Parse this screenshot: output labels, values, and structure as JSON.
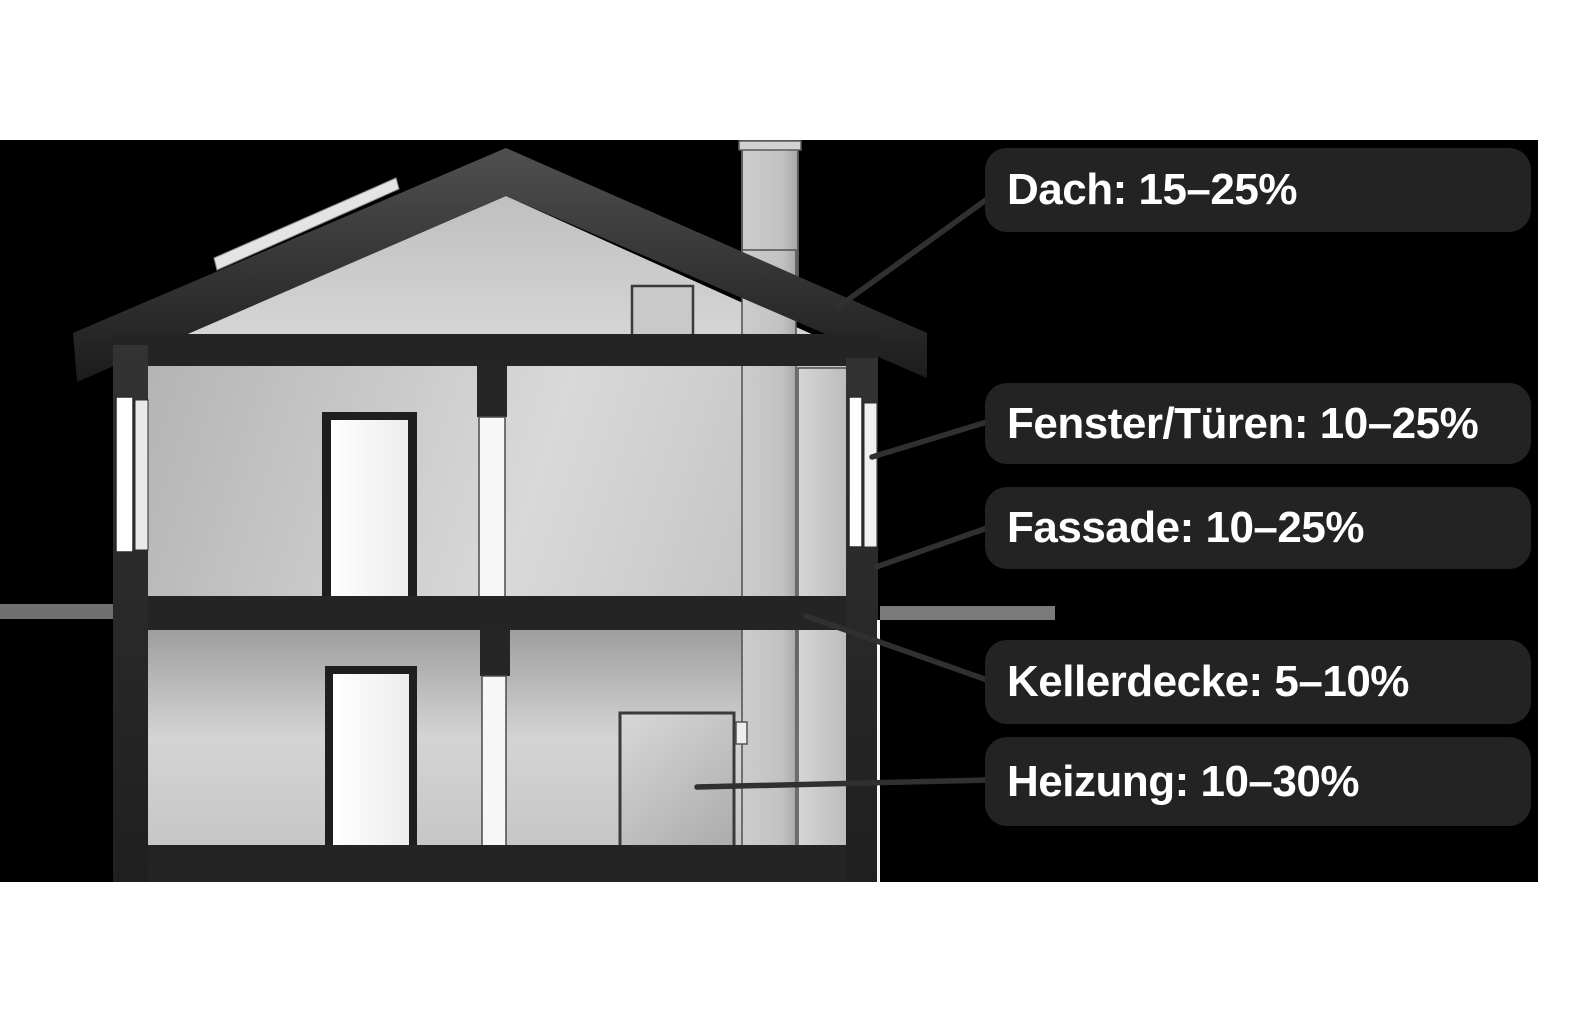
{
  "diagram": {
    "type": "house-cross-section-energy-savings-infographic",
    "language": "de",
    "labels": [
      {
        "id": "dach",
        "part": "Dach",
        "range": "15–25%",
        "text": "Dach: 15–25%"
      },
      {
        "id": "fenster",
        "part": "Fenster/Türen",
        "range": "10–25%",
        "text": "Fenster/Türen: 10–25%"
      },
      {
        "id": "fassade",
        "part": "Fassade",
        "range": "10–25%",
        "text": "Fassade: 10–25%"
      },
      {
        "id": "kellerdecke",
        "part": "Kellerdecke",
        "range": "5–10%",
        "text": "Kellerdecke: 5–10%"
      },
      {
        "id": "heizung",
        "part": "Heizung",
        "range": "10–30%",
        "text": "Heizung: 10–30%"
      }
    ],
    "colors": {
      "page_background": "#ffffff",
      "panel_background": "#000000",
      "callout_background": "#232323",
      "callout_text": "#ffffff",
      "structure_dark": "#242424",
      "roof_dark": "#2e2e2e",
      "interior_gray": "#cfcfcf",
      "chimney_gray": "#c6c6c6",
      "window_white": "#ffffff",
      "ground_line_gray": "#757575",
      "leader_line": "#303030"
    }
  }
}
